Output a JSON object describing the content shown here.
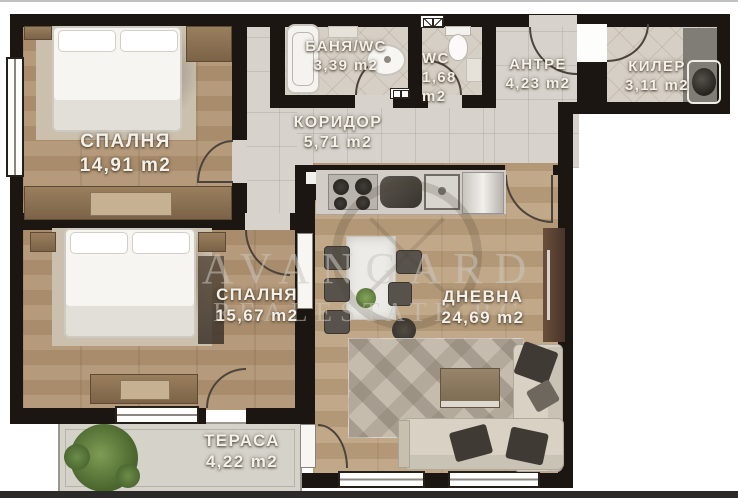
{
  "plan": {
    "rooms": [
      {
        "id": "bedroom1",
        "name": "СПАЛНЯ",
        "area": "14,91 m2"
      },
      {
        "id": "bath",
        "name": "БАНЯ/WC",
        "area": "3,39 m2"
      },
      {
        "id": "wc",
        "name": "WC",
        "area": "1,68 m2"
      },
      {
        "id": "entry",
        "name": "АНТРЕ",
        "area": "4,23 m2"
      },
      {
        "id": "closet",
        "name": "КИЛЕР",
        "area": "3,11 m2"
      },
      {
        "id": "corridor",
        "name": "КОРИДОР",
        "area": "5,71 m2"
      },
      {
        "id": "bedroom2",
        "name": "СПАЛНЯ",
        "area": "15,67 m2"
      },
      {
        "id": "living",
        "name": "ДНЕВНА",
        "area": "24,69 m2"
      },
      {
        "id": "terrace",
        "name": "ТЕРАСА",
        "area": "4,22 m2"
      }
    ],
    "watermark": {
      "line1": "AVANGARD",
      "line2": "REALESTATE.BG"
    },
    "colors": {
      "wall": "#1c1612",
      "wood": "#b59a7b",
      "tile": "#d7d3cc",
      "plant": "#5d7a3c"
    }
  }
}
